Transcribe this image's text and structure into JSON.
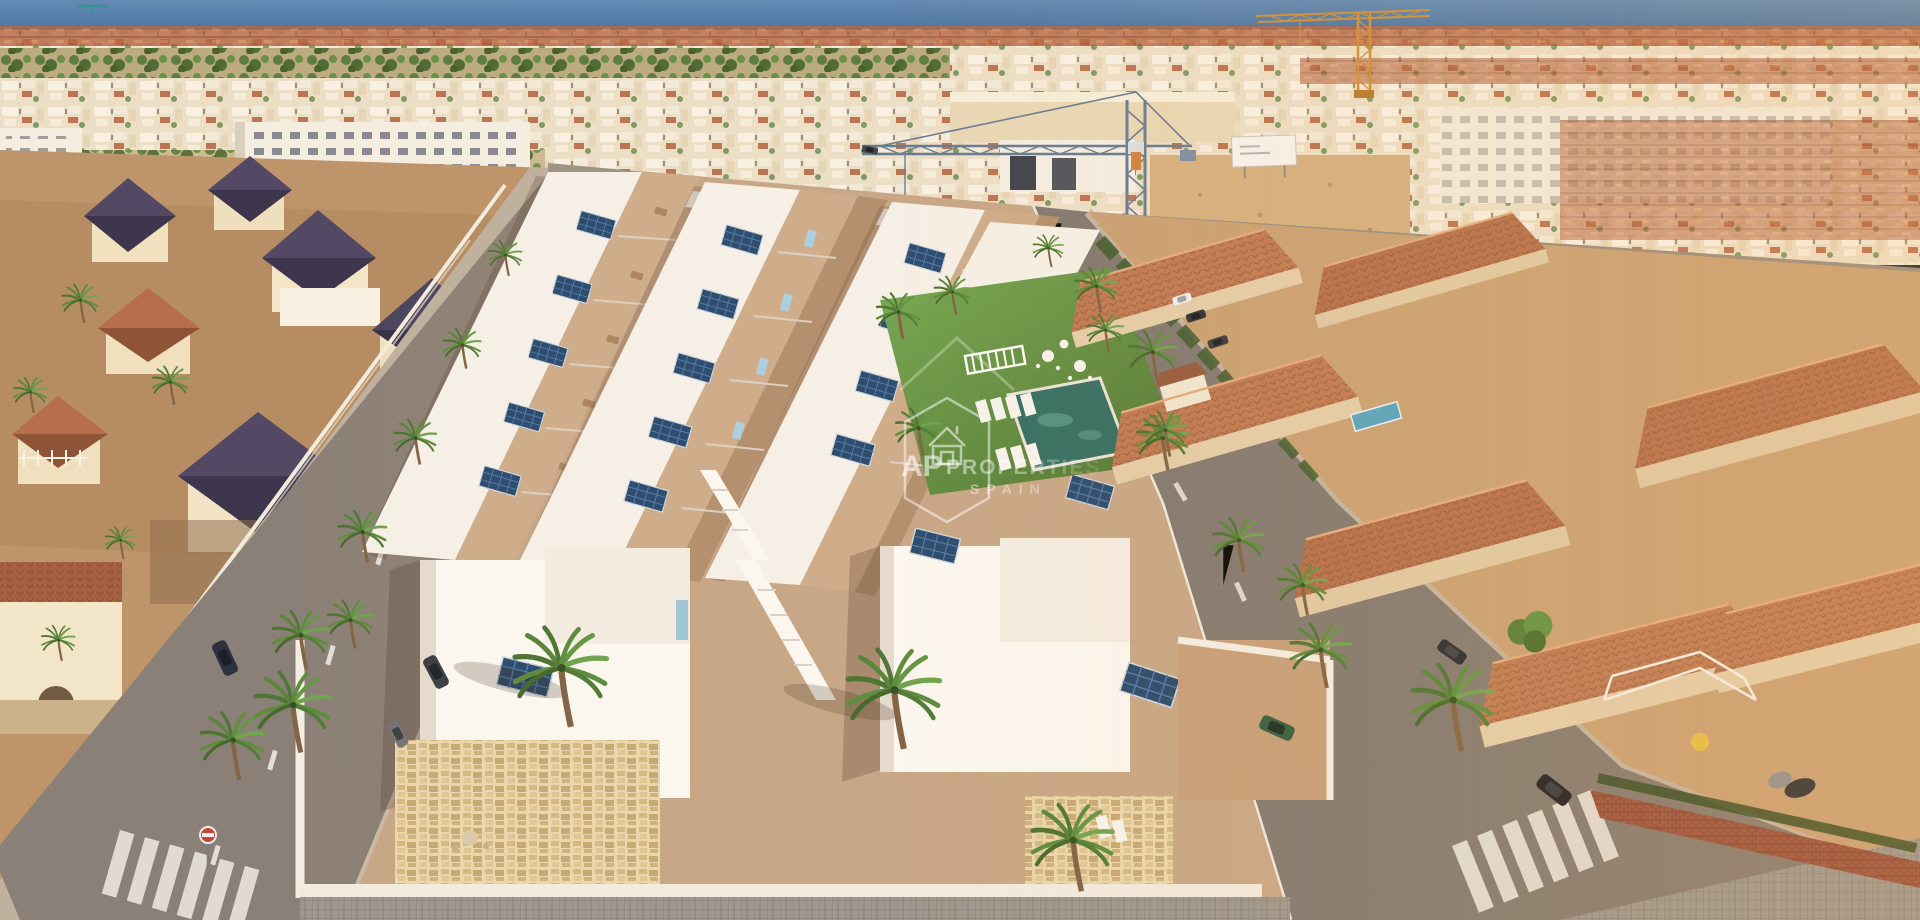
{
  "scene": {
    "description": "Aerial 3D render of a new-build development of white townhouses with roof terraces and solar panels and a communal pool garden, set between palm-lined streets, cream villas with dark pyramid roofs on the left, terracotta-roofed villas on the right, dense coastal town, tower cranes and the sea on the horizon",
    "watermark": {
      "brand_prefix": "AP",
      "brand_name": "PROPERTIES",
      "brand_region": "SPAIN"
    },
    "palette": {
      "sea": "#3e6fa1",
      "white_walls": "#f7f2e9",
      "terrace_tan": "#c6a585",
      "lawn": "#5d8c3b",
      "pool": "#2f6b60",
      "solar_panel": "#24466b",
      "accent_blue": "#a9cede",
      "terracotta_roof": "#a05a3a",
      "navy_roof": "#3d3752",
      "asphalt": "#857c74",
      "sand": "#cfa97d",
      "crane_orange": "#cf8c33",
      "crane_gray": "#63788f",
      "palm_green": "#55883a"
    },
    "features": [
      "three rows of white townhouses with blue solar panels",
      "communal lawn with swimming pool and sun loungers",
      "two foreground villas with stone-clad walls",
      "palm-lined streets with zebra crossings and parked cars",
      "existing terracotta-roof villas on the right",
      "cream villas with dark pyramid roofs on the left",
      "dense coastal town and sea horizon with construction cranes"
    ]
  }
}
